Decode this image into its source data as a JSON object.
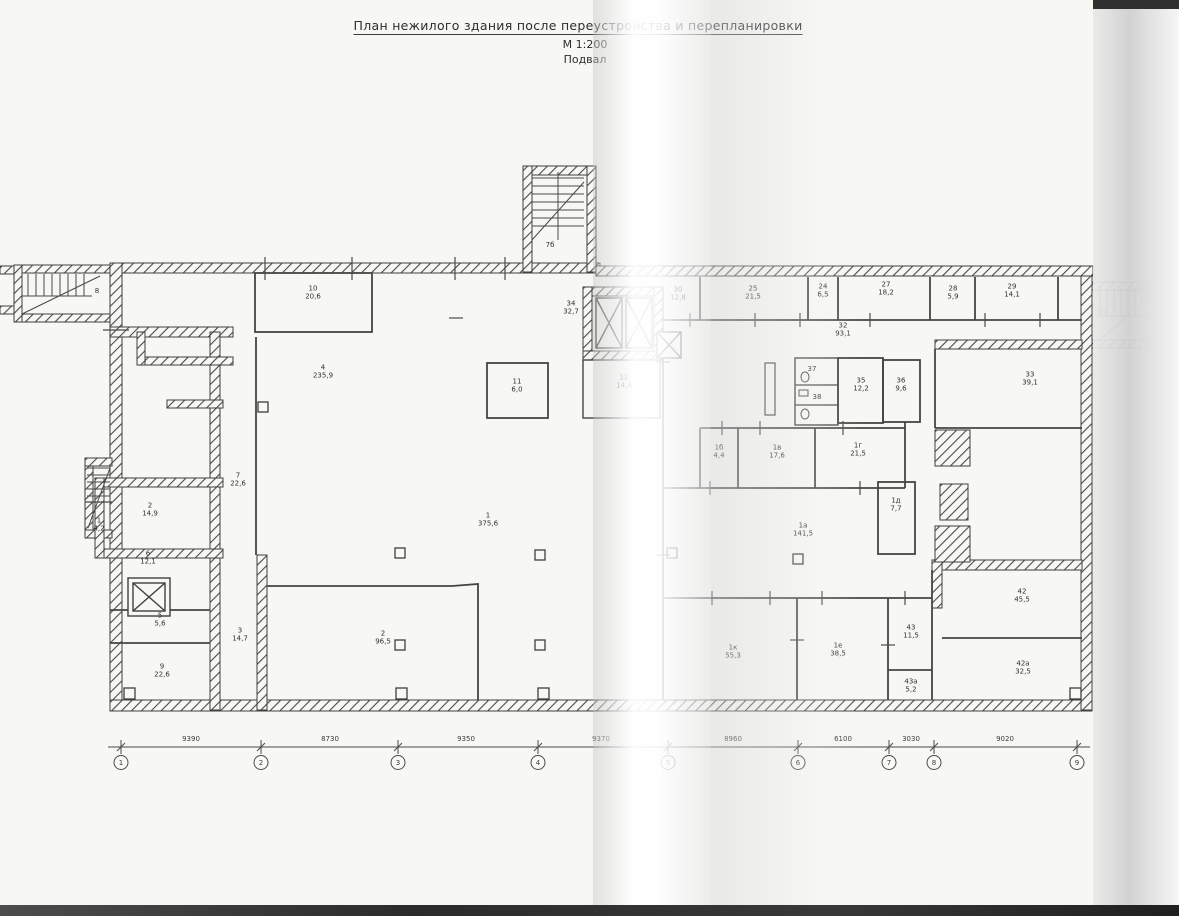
{
  "title": {
    "line1": "План нежилого здания после переустройства и перепланировки",
    "scale": "М 1:200",
    "floor": "Подвал"
  },
  "rooms": [
    {
      "num": "8",
      "area": "",
      "x": 97,
      "y": 291
    },
    {
      "num": "10",
      "area": "20,6",
      "x": 313,
      "y": 293
    },
    {
      "num": "7б",
      "area": "",
      "x": 550,
      "y": 245
    },
    {
      "num": "34",
      "area": "32,7",
      "x": 571,
      "y": 308
    },
    {
      "num": "4",
      "area": "235,9",
      "x": 323,
      "y": 372
    },
    {
      "num": "11",
      "area": "6,0",
      "x": 517,
      "y": 386
    },
    {
      "num": "12",
      "area": "14,4",
      "x": 624,
      "y": 382
    },
    {
      "num": "7",
      "area": "22,6",
      "x": 238,
      "y": 480
    },
    {
      "num": "2",
      "area": "14,9",
      "x": 150,
      "y": 510
    },
    {
      "num": "1",
      "area": "4,2",
      "x": 99,
      "y": 525
    },
    {
      "num": "6",
      "area": "12,1",
      "x": 148,
      "y": 558
    },
    {
      "num": "5",
      "area": "5,6",
      "x": 160,
      "y": 620
    },
    {
      "num": "3",
      "area": "14,7",
      "x": 240,
      "y": 635
    },
    {
      "num": "9",
      "area": "22,6",
      "x": 162,
      "y": 671
    },
    {
      "num": "1",
      "area": "375,6",
      "x": 488,
      "y": 520
    },
    {
      "num": "2",
      "area": "96,5",
      "x": 383,
      "y": 638
    },
    {
      "num": "30",
      "area": "12,8",
      "x": 678,
      "y": 294
    },
    {
      "num": "25",
      "area": "21,5",
      "x": 753,
      "y": 293
    },
    {
      "num": "24",
      "area": "6,5",
      "x": 823,
      "y": 291
    },
    {
      "num": "27",
      "area": "18,2",
      "x": 886,
      "y": 289
    },
    {
      "num": "28",
      "area": "5,9",
      "x": 953,
      "y": 293
    },
    {
      "num": "29",
      "area": "14,1",
      "x": 1012,
      "y": 291
    },
    {
      "num": "31",
      "area": "",
      "x": 1103,
      "y": 312
    },
    {
      "num": "32",
      "area": "93,1",
      "x": 843,
      "y": 330
    },
    {
      "num": "37",
      "area": "",
      "x": 812,
      "y": 369
    },
    {
      "num": "38",
      "area": "",
      "x": 817,
      "y": 397
    },
    {
      "num": "35",
      "area": "12,2",
      "x": 861,
      "y": 385
    },
    {
      "num": "36",
      "area": "9,6",
      "x": 901,
      "y": 385
    },
    {
      "num": "33",
      "area": "39,1",
      "x": 1030,
      "y": 379
    },
    {
      "num": "1б",
      "area": "4,4",
      "x": 719,
      "y": 452
    },
    {
      "num": "1в",
      "area": "17,6",
      "x": 777,
      "y": 452
    },
    {
      "num": "1г",
      "area": "21,5",
      "x": 858,
      "y": 450
    },
    {
      "num": "1д",
      "area": "7,7",
      "x": 896,
      "y": 505
    },
    {
      "num": "1а",
      "area": "141,5",
      "x": 803,
      "y": 530
    },
    {
      "num": "1к",
      "area": "55,3",
      "x": 733,
      "y": 652
    },
    {
      "num": "1е",
      "area": "38,5",
      "x": 838,
      "y": 650
    },
    {
      "num": "43",
      "area": "11,5",
      "x": 911,
      "y": 632
    },
    {
      "num": "43а",
      "area": "5,2",
      "x": 911,
      "y": 686
    },
    {
      "num": "42",
      "area": "45,5",
      "x": 1022,
      "y": 596
    },
    {
      "num": "42а",
      "area": "32,5",
      "x": 1023,
      "y": 668
    }
  ],
  "dimensions": [
    {
      "text": "9390",
      "x": 191
    },
    {
      "text": "8730",
      "x": 330
    },
    {
      "text": "9350",
      "x": 466
    },
    {
      "text": "9370",
      "x": 601
    },
    {
      "text": "8960",
      "x": 733
    },
    {
      "text": "6100",
      "x": 843
    },
    {
      "text": "3030",
      "x": 911
    },
    {
      "text": "9020",
      "x": 1005
    }
  ],
  "axes": [
    {
      "label": "1",
      "x": 121
    },
    {
      "label": "2",
      "x": 261
    },
    {
      "label": "3",
      "x": 398
    },
    {
      "label": "4",
      "x": 538
    },
    {
      "label": "5",
      "x": 668
    },
    {
      "label": "6",
      "x": 798
    },
    {
      "label": "7",
      "x": 889
    },
    {
      "label": "8",
      "x": 934
    },
    {
      "label": "9",
      "x": 1077
    }
  ],
  "colors": {
    "paper": "#f7f7f4",
    "ink": "#3f3f3f",
    "scan_strip": "#303030"
  }
}
